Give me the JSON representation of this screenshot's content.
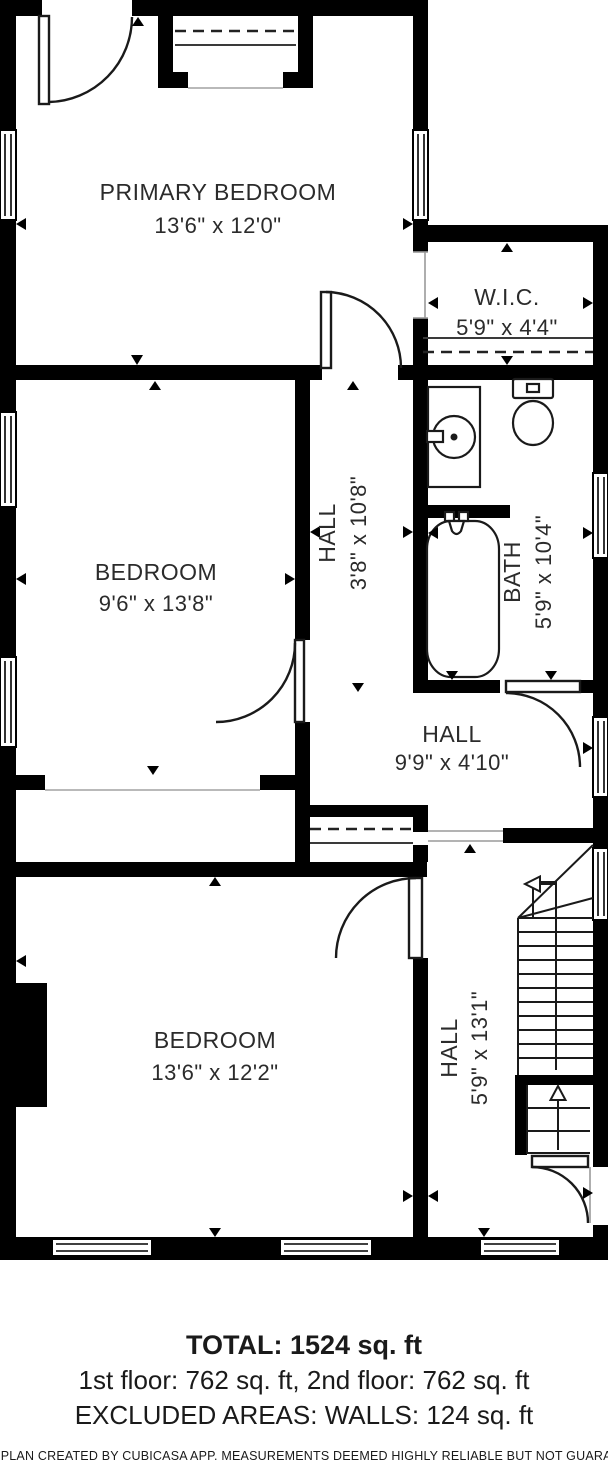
{
  "plan": {
    "title": "2nd floor plan",
    "rooms": {
      "primary_bedroom": {
        "name": "PRIMARY BEDROOM",
        "dims": "13'6\" x 12'0\""
      },
      "wic": {
        "name": "W.I.C.",
        "dims": "5'9\" x 4'4\""
      },
      "bedroom_middle": {
        "name": "BEDROOM",
        "dims": "9'6\" x 13'8\""
      },
      "hall_upper": {
        "name": "HALL",
        "dims": "3'8\" x 10'8\""
      },
      "bath": {
        "name": "BATH",
        "dims": "5'9\" x 10'4\""
      },
      "hall_middle": {
        "name": "HALL",
        "dims": "9'9\" x 4'10\""
      },
      "bedroom_lower": {
        "name": "BEDROOM",
        "dims": "13'6\" x 12'2\""
      },
      "hall_lower": {
        "name": "HALL",
        "dims": "5'9\" x 13'1\""
      }
    },
    "fixtures": [
      "sink-vanity",
      "toilet",
      "bathtub",
      "stairs",
      "closet-rod",
      "closet-shelf"
    ],
    "colors": {
      "walls": "#000000",
      "text": "#2b2b2b",
      "background": "#ffffff"
    }
  },
  "summary": {
    "total": "TOTAL: 1524 sq. ft",
    "floors": "1st floor: 762 sq. ft, 2nd floor: 762 sq. ft",
    "excluded": "EXCLUDED AREAS: WALLS: 124 sq. ft"
  },
  "footer": {
    "disclaimer": "FLOOR PLAN CREATED BY CUBICASA APP. MEASUREMENTS DEEMED HIGHLY RELIABLE BUT NOT GUARANTEED"
  }
}
